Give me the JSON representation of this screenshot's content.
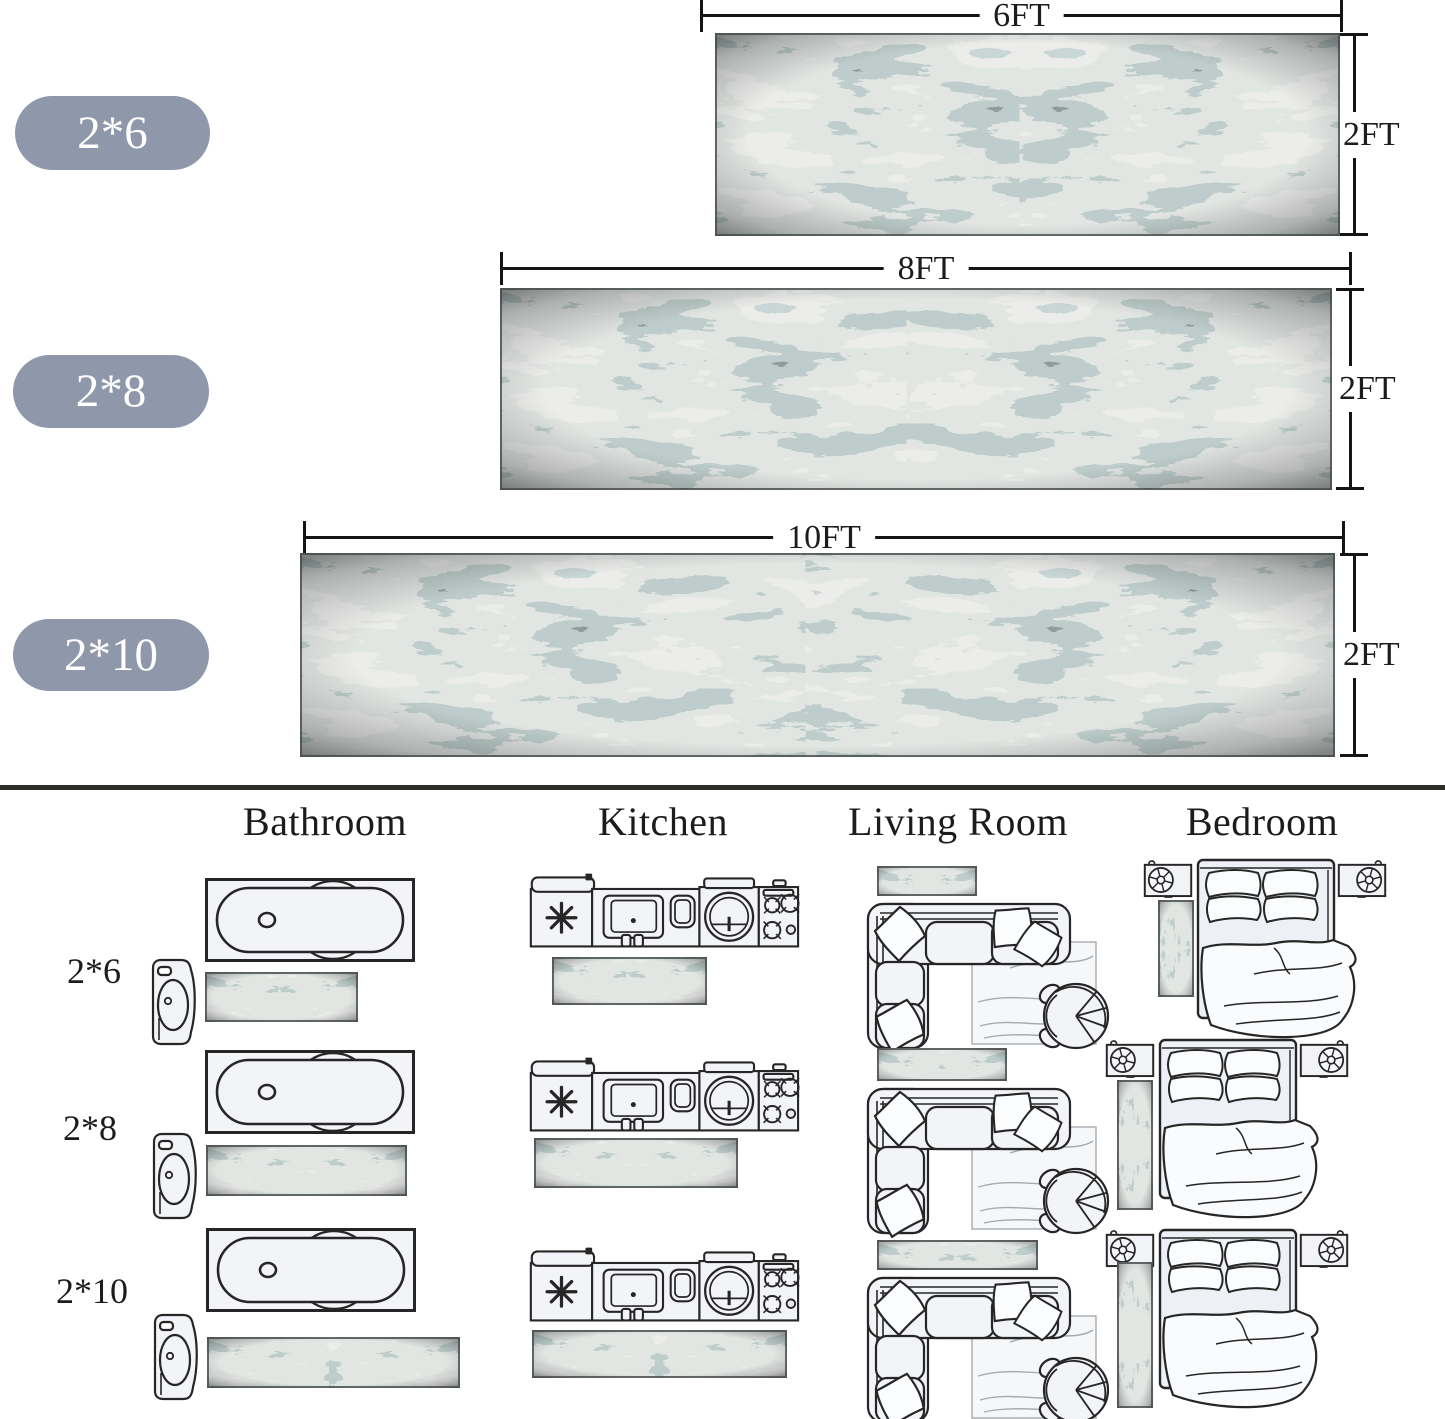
{
  "size_guide": {
    "badge_color": "#8e98aa",
    "rows": [
      {
        "badge": "2*6",
        "length_label": "6FT",
        "width_label": "2FT"
      },
      {
        "badge": "2*8",
        "length_label": "8FT",
        "width_label": "2FT"
      },
      {
        "badge": "2*10",
        "length_label": "10FT",
        "width_label": "2FT"
      }
    ]
  },
  "room_guide": {
    "columns": [
      "Bathroom",
      "Kitchen",
      "Living Room",
      "Bedroom"
    ],
    "row_labels": [
      "2*6",
      "2*8",
      "2*10"
    ]
  },
  "icons": {
    "bathroom": [
      "bathtub-icon",
      "pedestal-sink-icon"
    ],
    "kitchen": [
      "kitchen-counter-icon"
    ],
    "living_room": [
      "sectional-sofa-icon",
      "round-chair-icon"
    ],
    "bedroom": [
      "bed-icon",
      "nightstand-icon"
    ]
  },
  "rug_palette": {
    "dark": "#23282a",
    "slate": "#6f7d7b",
    "teal": "#9fb4b1",
    "light": "#cfd1cb"
  }
}
